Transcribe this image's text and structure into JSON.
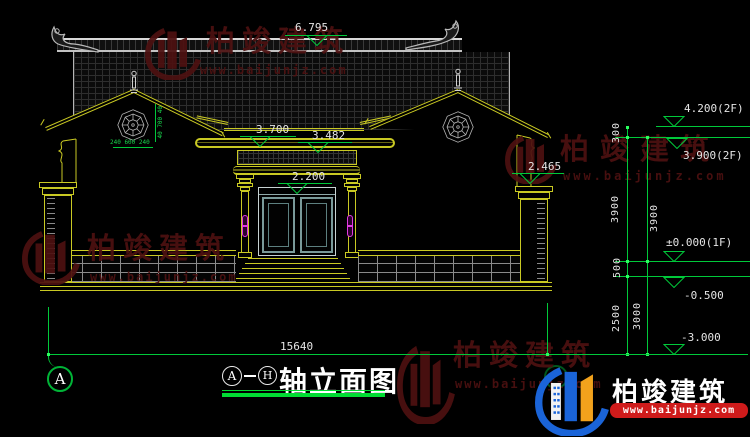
{
  "title": {
    "axis_start": "A",
    "axis_end": "H",
    "name": "轴立面图"
  },
  "levels": {
    "ridge": "6.795",
    "main_eave": "3.700",
    "canopy": "3.482",
    "door": "2.200",
    "side_eave": "2.465",
    "f2_roof": "4.200(2F)",
    "f2": "3.900(2F)",
    "f1": "±0.000(1F)",
    "ground": "-0.500",
    "foundation": "-3.000"
  },
  "dimensions": {
    "total_width": "15640",
    "chain_inner": [
      "300",
      "3900",
      "500",
      "2500"
    ],
    "chain_outer": [
      "3900",
      "3000"
    ],
    "window_h": "240 600 240",
    "window_v": "40 700 40"
  },
  "watermark": {
    "brand": "柏竣建筑",
    "url": "www.baijunjz.com"
  }
}
